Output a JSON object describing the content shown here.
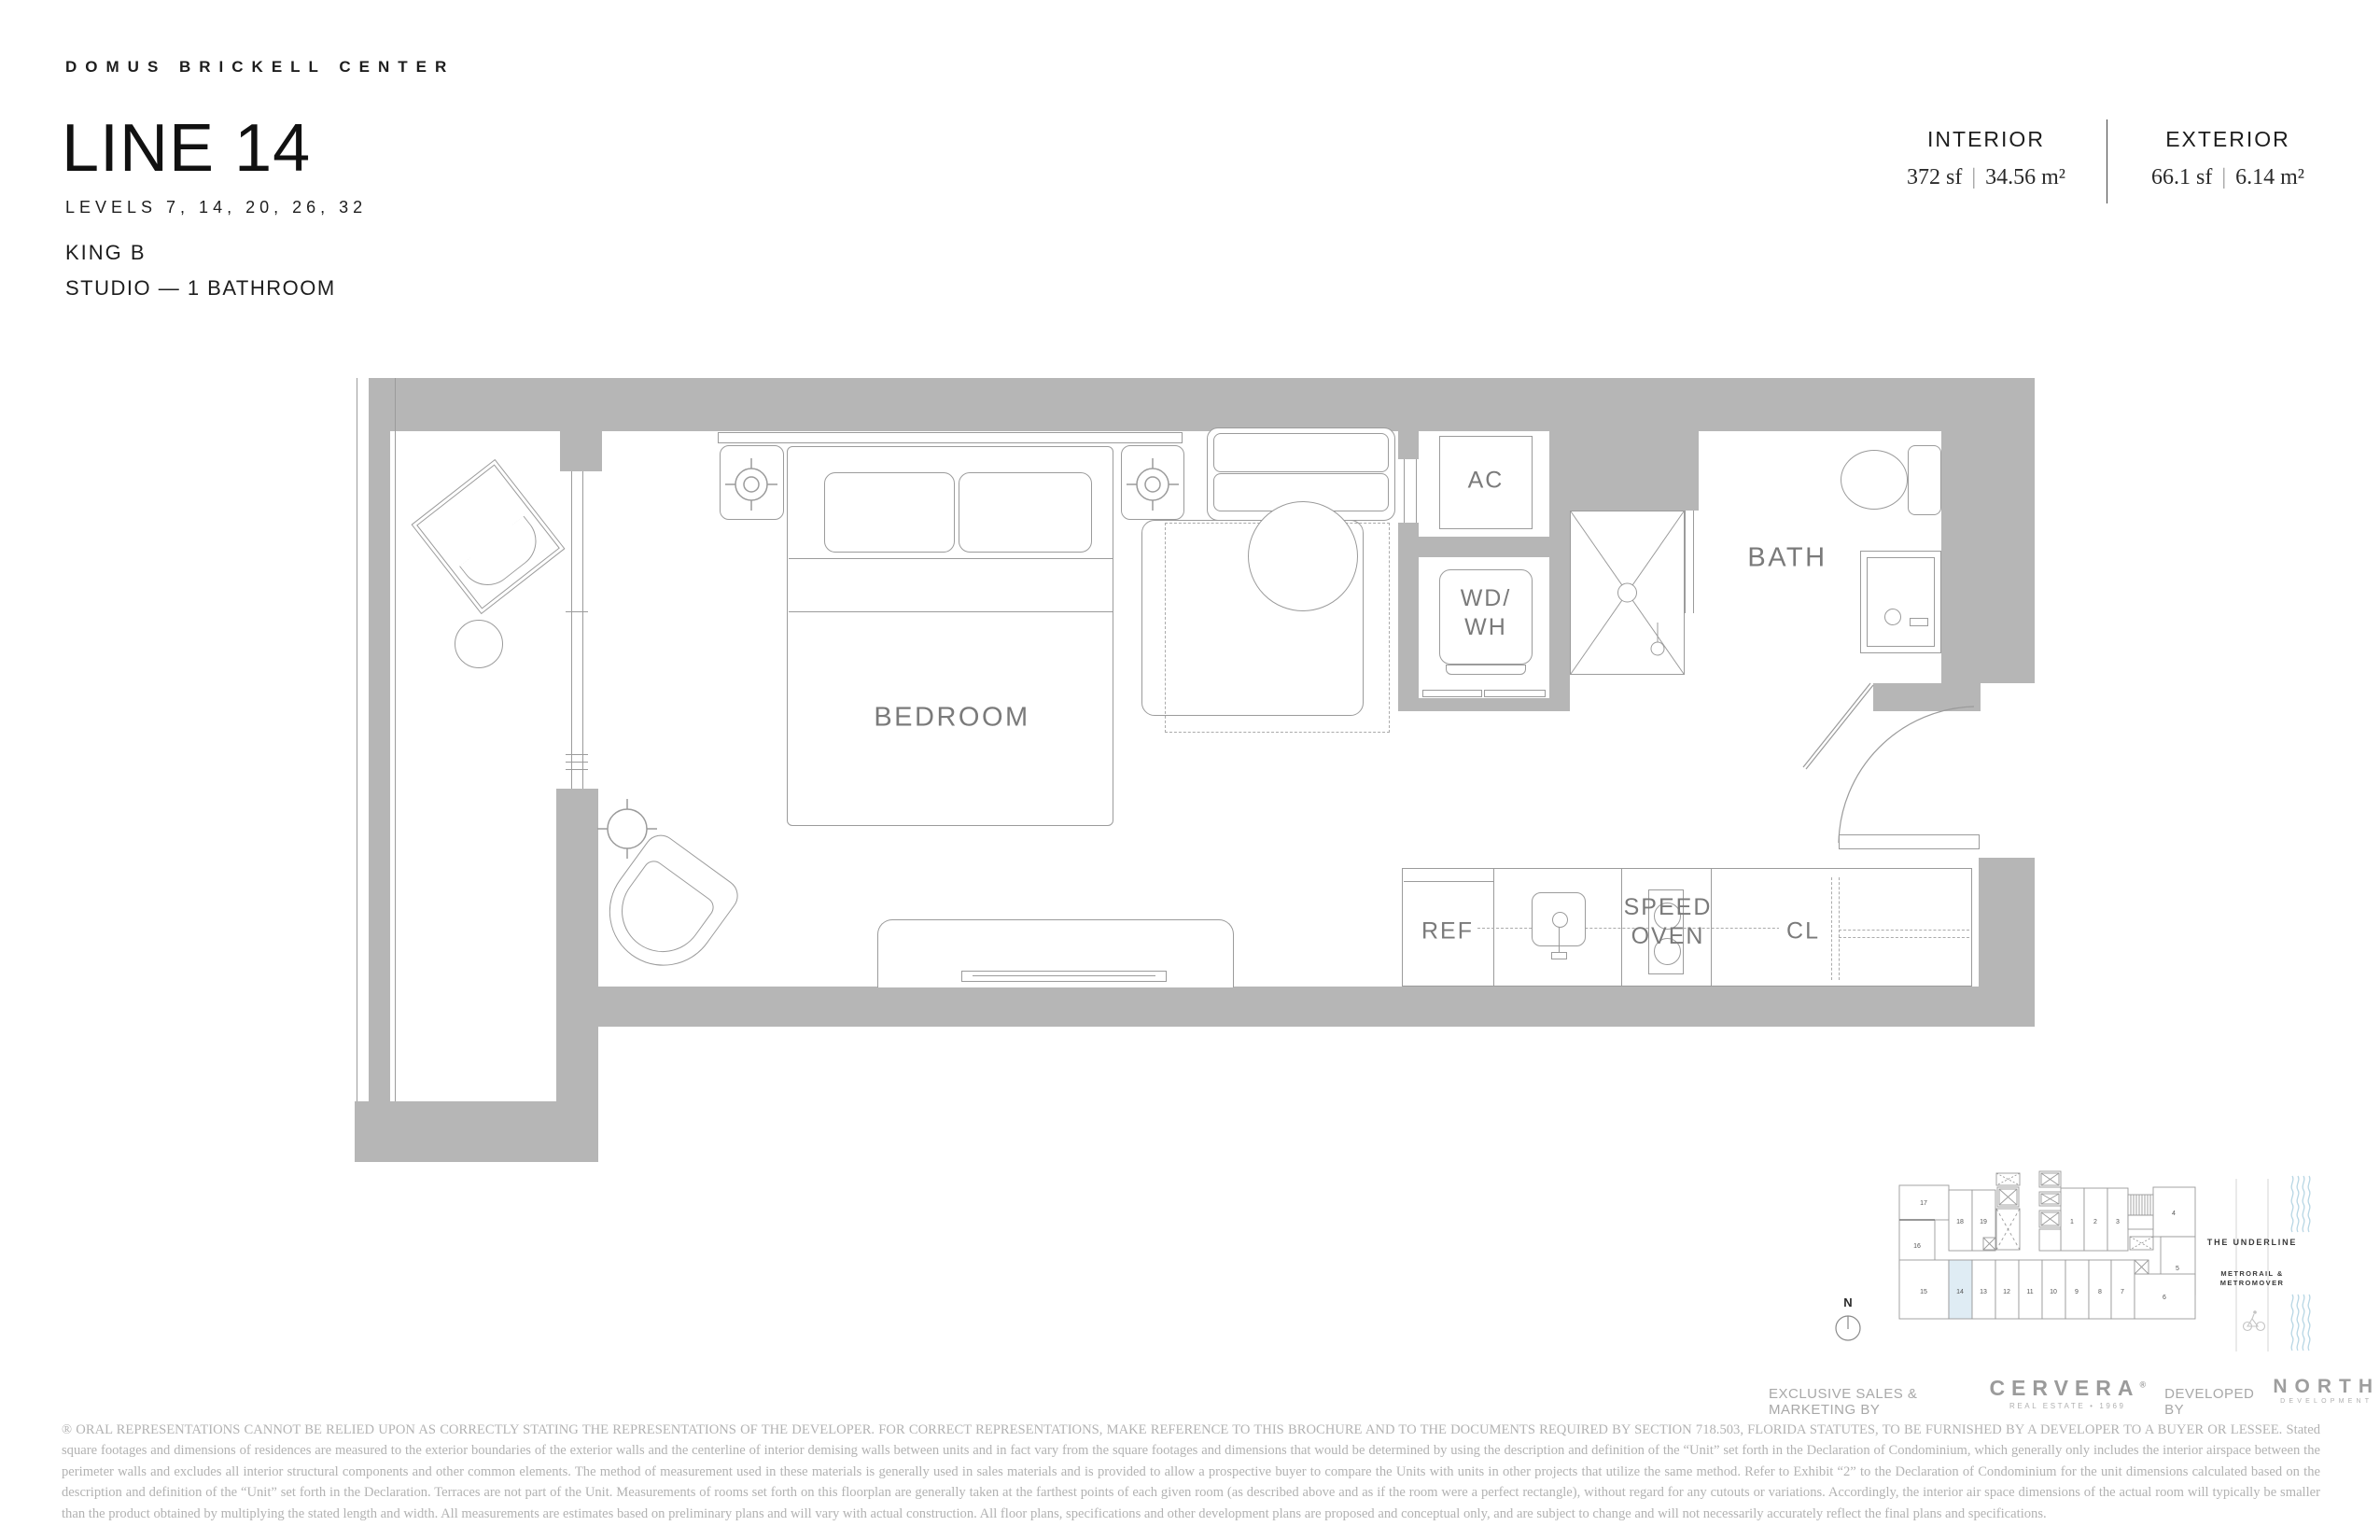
{
  "header": {
    "project": "DOMUS BRICKELL CENTER",
    "line_title": "LINE 14",
    "levels": "LEVELS 7, 14, 20, 26, 32",
    "unit_type": "KING B",
    "unit_config": "STUDIO — 1 BATHROOM"
  },
  "stats": {
    "interior_label": "INTERIOR",
    "interior_sf": "372 sf",
    "interior_m2": "34.56 m²",
    "exterior_label": "EXTERIOR",
    "exterior_sf": "66.1 sf",
    "exterior_m2": "6.14 m²",
    "separator": "|"
  },
  "plan_labels": {
    "bedroom": "BEDROOM",
    "ac": "AC",
    "wd": "WD/",
    "wh": "WH",
    "bath": "BATH",
    "ref": "REF",
    "speed": "SPEED",
    "oven": "OVEN",
    "cl": "CL"
  },
  "keyplan": {
    "compass": "N",
    "underline": "THE UNDERLINE",
    "metro_line1": "METRORAIL &",
    "metro_line2": "METROMOVER",
    "highlighted_unit": "14",
    "highlight_color": "#dfecf4",
    "units": {
      "u1": "1",
      "u2": "2",
      "u3": "3",
      "u4": "4",
      "u5": "5",
      "u6": "6",
      "u7": "7",
      "u8": "8",
      "u9": "9",
      "u10": "10",
      "u11": "11",
      "u12": "12",
      "u13": "13",
      "u14": "14",
      "u15": "15",
      "u16": "16",
      "u17": "17",
      "u18": "18",
      "u19": "19"
    }
  },
  "footer": {
    "sales_prefix": "EXCLUSIVE SALES & MARKETING BY",
    "cervera_logo": "CERVERA",
    "cervera_reg": "®",
    "cervera_sub": "REAL ESTATE • 1969",
    "developed_prefix": "DEVELOPED BY",
    "north_logo": "NORTH",
    "north_sub": "DEVELOPMENT",
    "disclaimer": "® ORAL REPRESENTATIONS CANNOT BE RELIED UPON AS CORRECTLY STATING THE REPRESENTATIONS OF THE DEVELOPER. FOR CORRECT REPRESENTATIONS, MAKE REFERENCE TO THIS BROCHURE AND TO THE DOCUMENTS REQUIRED BY SECTION 718.503, FLORIDA STATUTES, TO BE FURNISHED BY A DEVELOPER TO A BUYER OR LESSEE. Stated square footages and dimensions of residences are measured to the exterior boundaries of the exterior walls and the centerline of interior demising walls between units and in fact vary from the square footages and dimensions that would be determined by using the description and definition of the “Unit” set forth in the Declaration of Condominium, which generally only includes the interior airspace between the perimeter walls and excludes all interior structural components and other common elements.  The method of measurement used in these materials is generally used in sales materials and is provided to allow a prospective buyer to compare the Units with units in other projects that utilize the same method. Refer to Exhibit “2” to the Declaration of Condominium for the unit dimensions calculated based on the description and definition of the “Unit” set forth in the Declaration. Terraces are not part of the Unit.  Measurements of rooms set forth on this floorplan are generally taken at the farthest points of each given room (as described above and as if the room were a perfect rectangle), without regard for any cutouts or variations.  Accordingly, the interior air space dimensions of the actual room will typically be smaller than the product obtained by multiplying the stated length and width.  All measurements are estimates based on preliminary plans and will vary with actual construction. All floor plans, specifications and other development plans are proposed and conceptual only, and are subject to change and will not necessarily accurately reflect the final plans and specifications."
  },
  "colors": {
    "wall": "#b6b6b6",
    "line": "#9b9b9b",
    "label": "#7a7a7a",
    "dash": "#ababab",
    "accent_blue": "#dfecf4",
    "wave_blue": "#b7d6e4",
    "header_text": "#1d1d1d",
    "disclaimer_text": "#b2b2b2"
  }
}
